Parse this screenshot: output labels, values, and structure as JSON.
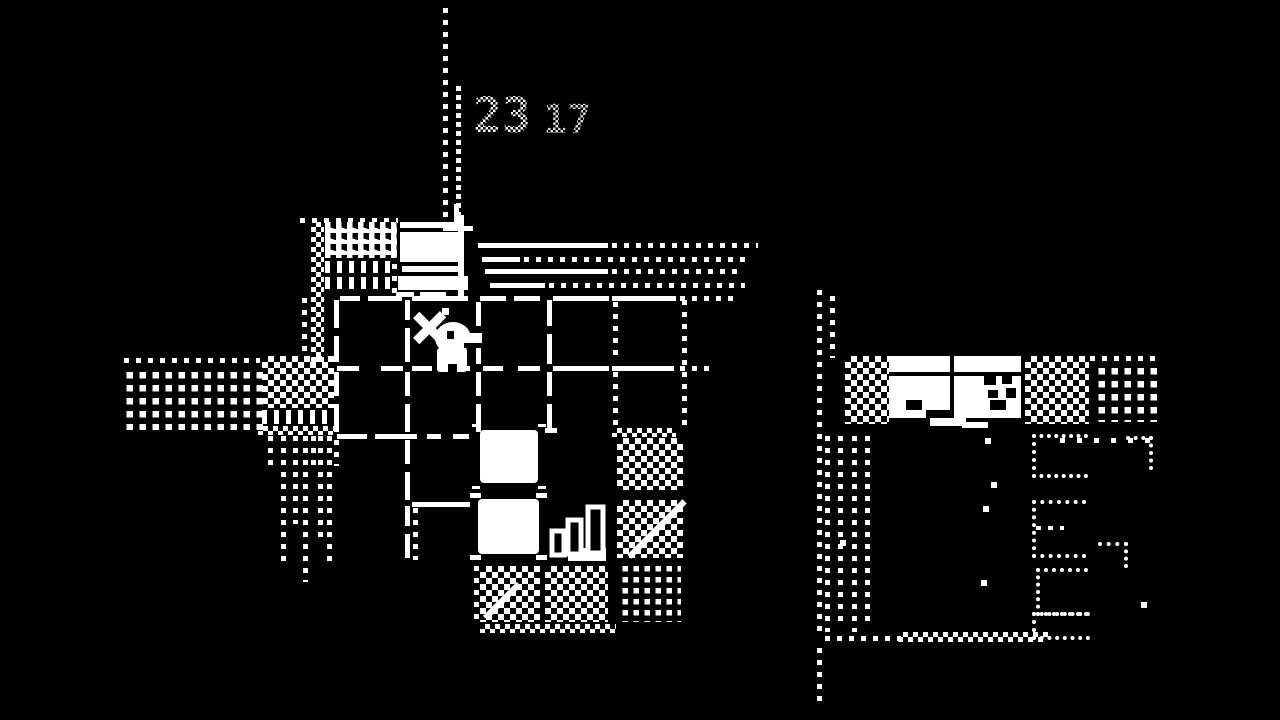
{
  "colors": {
    "background": "#000000",
    "foreground": "#ffffff"
  },
  "hud": {
    "counter_left": "23",
    "counter_right": "17"
  },
  "sprites": {
    "player": "player-with-crossed-pickaxe",
    "stairs": "ascending-stairs",
    "building_main": "white-building-sign",
    "building_right": "building-with-windows"
  },
  "map": {
    "style": "1-bit dithered dungeon map",
    "explored_room_grid": "4x4 rooms, solid walls with door gaps",
    "unexplored": "checkerboard and dotted rooms"
  }
}
